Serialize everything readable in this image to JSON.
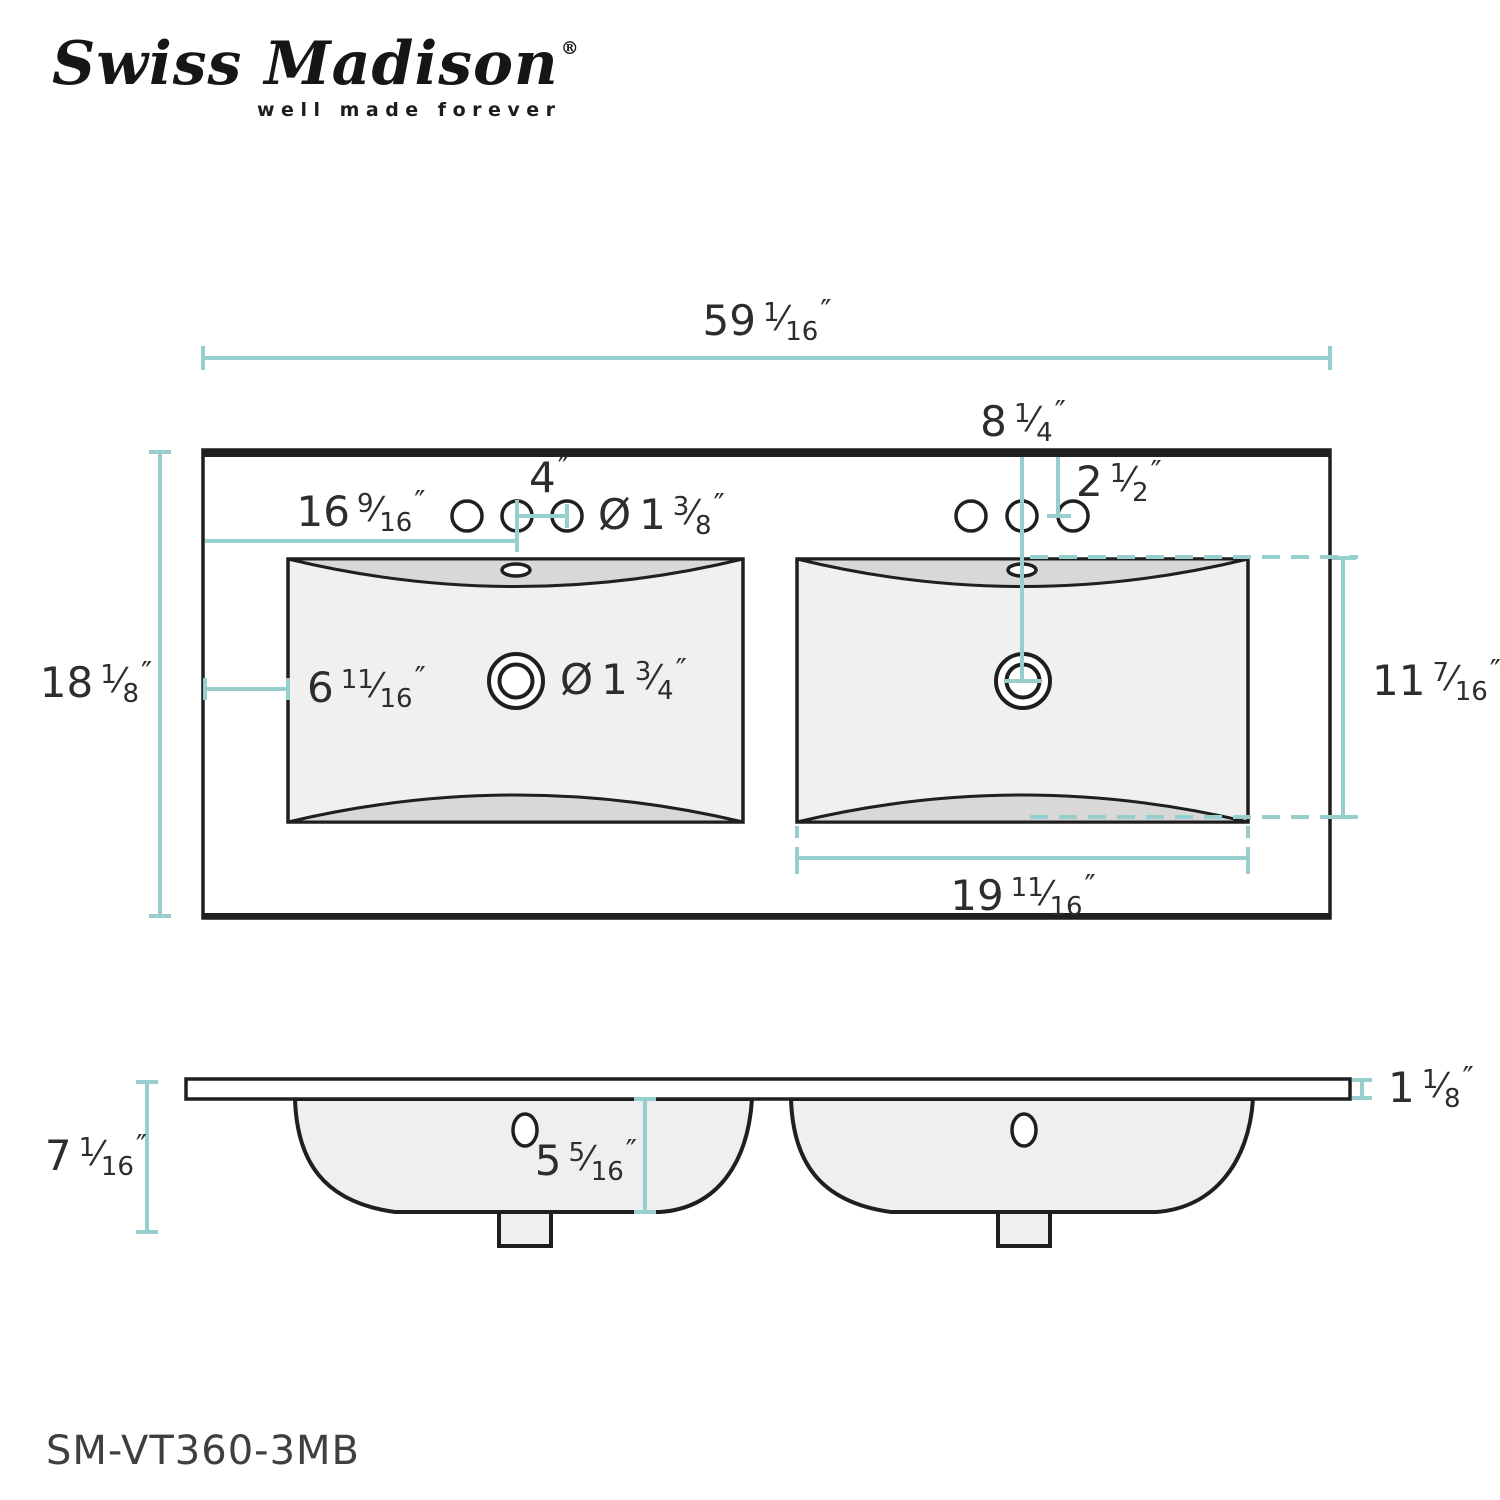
{
  "brand": {
    "name": "Swiss Madison",
    "registered": "®",
    "tagline": "well made forever"
  },
  "model": "SM-VT360-3MB",
  "glyphs": {
    "slash": "⁄",
    "inch": "″"
  },
  "colors": {
    "dimension_teal": "#97cfcf",
    "line_black": "#1f1f1f",
    "text": "#2d2d2d",
    "sink_fill": "#f0f0f0",
    "basin_shade": "#d8d8d8"
  },
  "views": {
    "top_view": "countertop plan with double basin",
    "side_view": "front elevation with two bowls"
  },
  "dimensions": {
    "overall_width": {
      "whole": "59",
      "num": "1",
      "den": "16",
      "unit": "″"
    },
    "overall_depth": {
      "whole": "18",
      "num": "1",
      "den": "8",
      "unit": "″"
    },
    "left_faucet_offset": {
      "whole": "16",
      "num": "9",
      "den": "16",
      "unit": "″"
    },
    "left_faucet_spacing": {
      "whole": "4",
      "unit": "″"
    },
    "faucet_hole_diameter": {
      "prefix": "Ø",
      "whole": "1",
      "num": "3",
      "den": "8",
      "unit": "″"
    },
    "right_faucet_spread": {
      "whole": "8",
      "num": "1",
      "den": "4",
      "unit": "″"
    },
    "right_hole_offset": {
      "whole": "2",
      "num": "1",
      "den": "2",
      "unit": "″"
    },
    "basin_left_offset": {
      "whole": "6",
      "num": "11",
      "den": "16",
      "unit": "″"
    },
    "drain_diameter": {
      "prefix": "Ø",
      "whole": "1",
      "num": "3",
      "den": "4",
      "unit": "″"
    },
    "basin_front_depth": {
      "whole": "11",
      "num": "7",
      "den": "16",
      "unit": "″"
    },
    "basin_width": {
      "whole": "19",
      "num": "11",
      "den": "16",
      "unit": "″"
    },
    "side_overall_height": {
      "whole": "7",
      "num": "1",
      "den": "16",
      "unit": "″"
    },
    "bowl_depth": {
      "whole": "5",
      "num": "5",
      "den": "16",
      "unit": "″"
    },
    "countertop_thickness": {
      "whole": "1",
      "num": "1",
      "den": "8",
      "unit": "″"
    }
  }
}
